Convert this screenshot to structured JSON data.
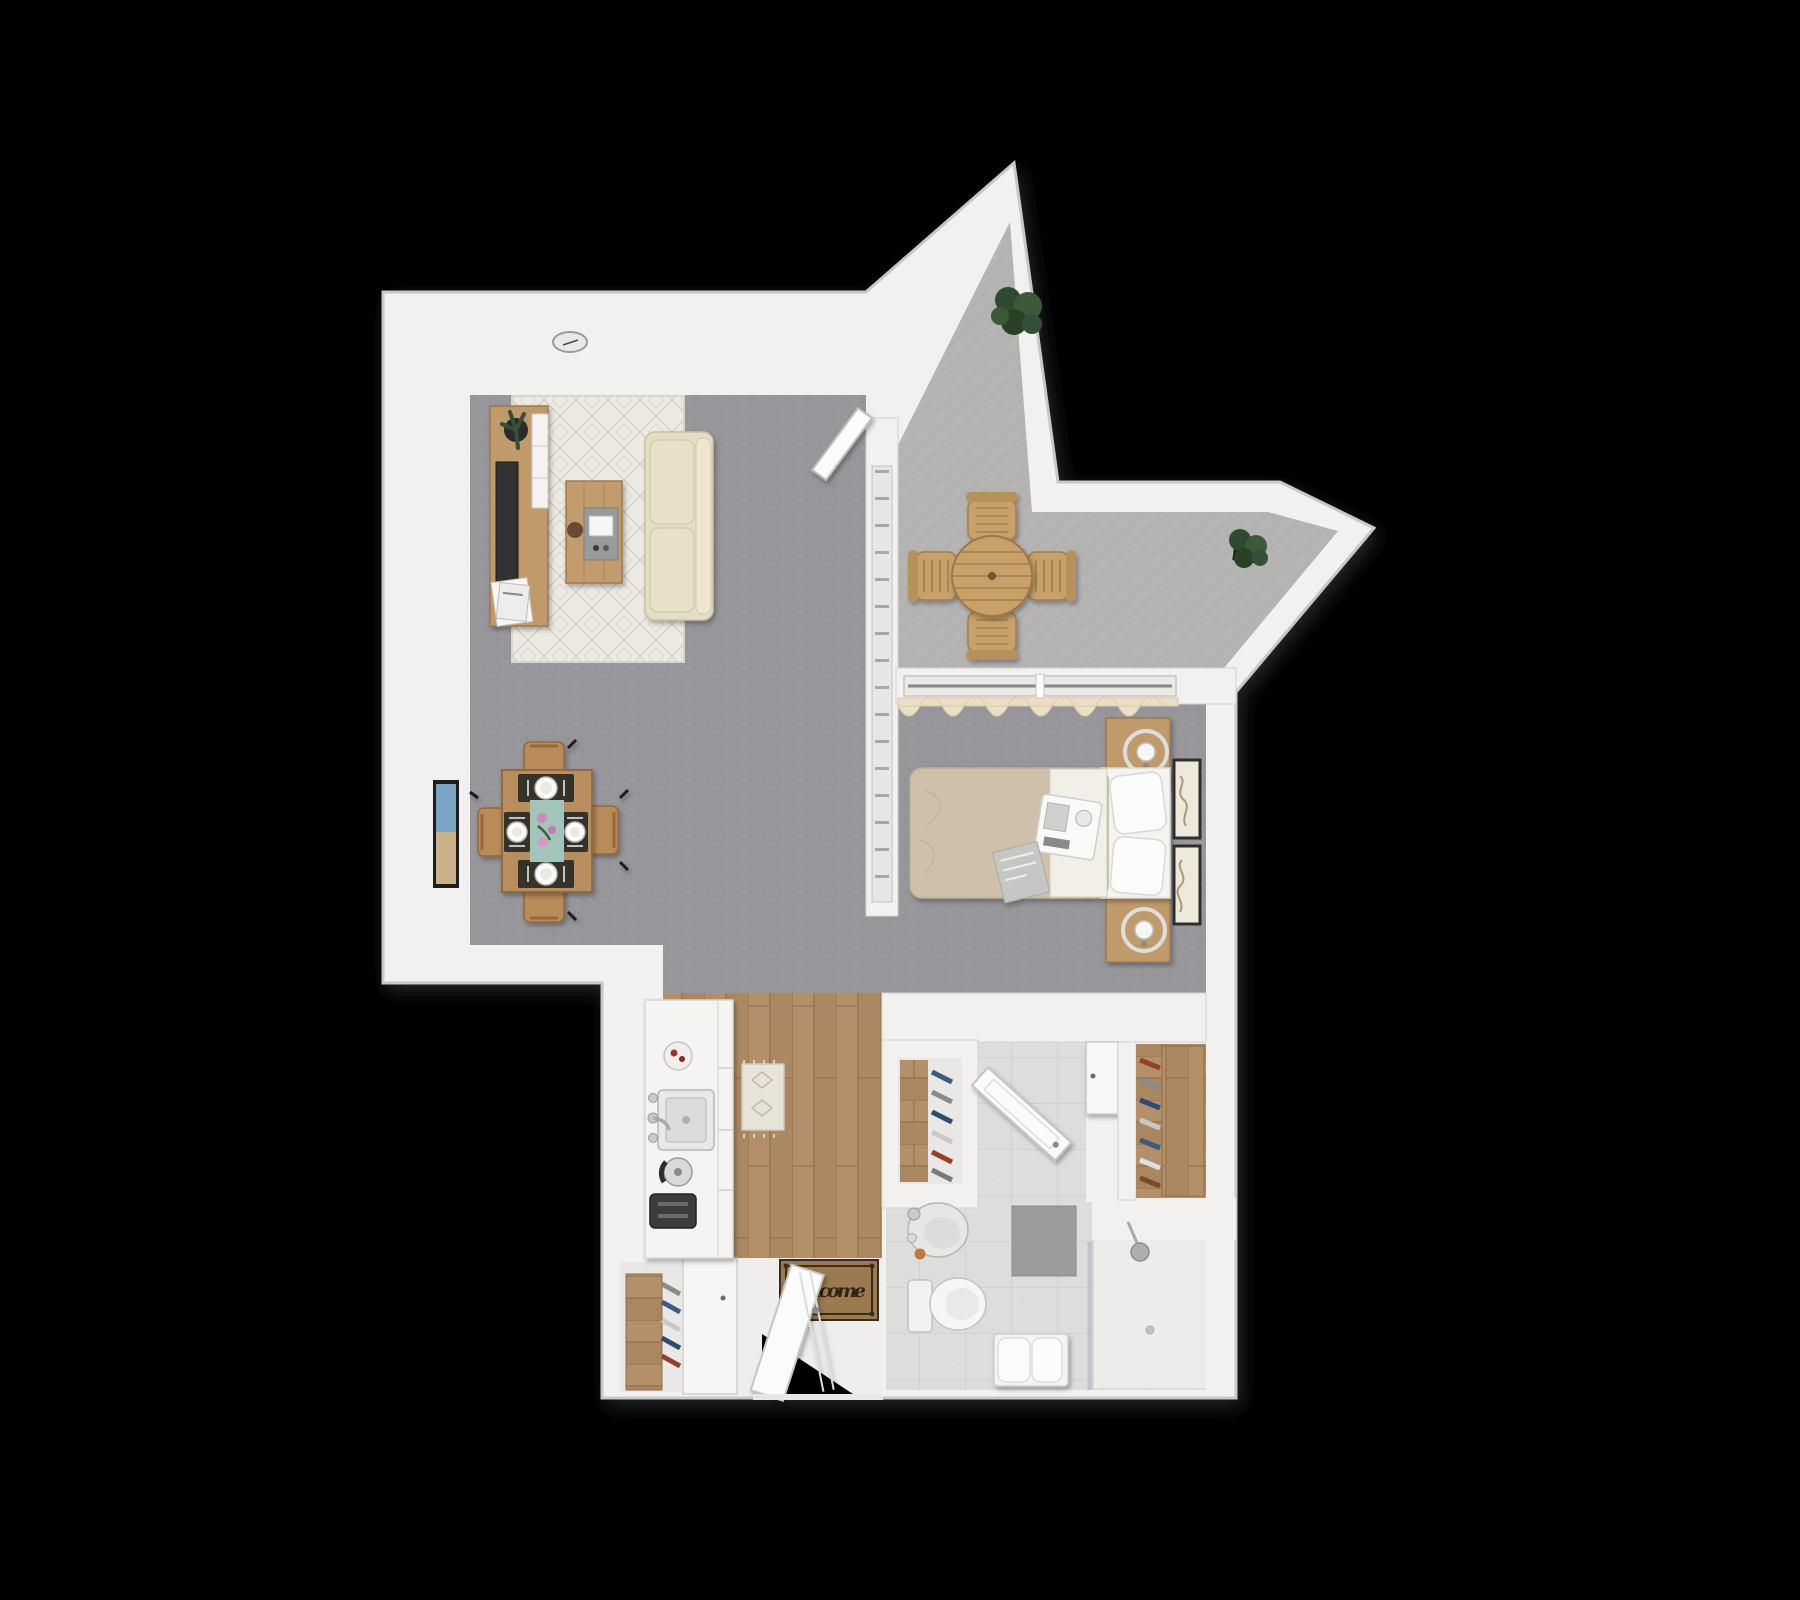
{
  "scene": {
    "description": "3D rendered top-down floor plan of a studio apartment on a black background",
    "background": "#000000"
  },
  "entry_mat": {
    "text": "welcome"
  },
  "colors": {
    "wall": "#f2f1ef",
    "wall_edge": "#c9c8c6",
    "carpet": "#97979b",
    "balcony_floor": "#b5b4b2",
    "wood_floor": "#b3906a",
    "tile_floor": "#dddddb",
    "shower_floor": "#ececea",
    "rug": "#edeae4",
    "runner_rug": "#e8e4da",
    "sofa": "#e6ddc5",
    "cushion": "#e9e0c9",
    "wood_furniture": "#c09a6a",
    "dining_table": "#b98e5f",
    "table_runner": "#a3c4bb",
    "flowers": "#d089c0",
    "duvet": "#cfc0ab",
    "linen": "#f4f3ef",
    "plant": "#35503a",
    "mat": "#9b7a50",
    "door": "#fbfbf9",
    "glass": "#b9c2c6",
    "tv": "#333336",
    "toaster": "#3c3c3a",
    "tray": "#9a9a98"
  },
  "rooms": {
    "living_room": {
      "name": "Living room",
      "furniture": [
        "media console",
        "tv",
        "console plant",
        "magazines",
        "area rug",
        "sofa",
        "coffee table",
        "ceiling light"
      ]
    },
    "dining_area": {
      "name": "Dining area",
      "furniture": [
        "dining table",
        "4 chairs",
        "4 place settings",
        "table runner with flowers",
        "wall window art"
      ]
    },
    "balcony": {
      "name": "Balcony",
      "furniture": [
        "round patio table",
        "4 patio chairs",
        "2 potted plants"
      ]
    },
    "sleeping_area": {
      "name": "Sleeping area",
      "furniture": [
        "double bed",
        "2 pillows",
        "breakfast tray",
        "magazine",
        "2 nightstands",
        "2 ring lamps",
        "2 wall pictures",
        "curtains",
        "sliding glass door"
      ]
    },
    "kitchen": {
      "name": "Kitchen",
      "furniture": [
        "counter",
        "plate with food",
        "sink",
        "kettle",
        "toaster",
        "end cabinet"
      ]
    },
    "hallway": {
      "name": "Entry hall",
      "furniture": [
        "runner rug",
        "welcome mat",
        "front door"
      ]
    },
    "entry_closet": {
      "name": "Entry closet",
      "furniture": [
        "shelf board",
        "hanging clothes"
      ]
    },
    "shoe_closet": {
      "name": "Shoe closet",
      "furniture": [
        "shelf board",
        "shoes"
      ]
    },
    "walk_in_closet": {
      "name": "Walk-in closet",
      "furniture": [
        "shelf board",
        "hanging clothes"
      ]
    },
    "bathroom": {
      "name": "Bathroom",
      "furniture": [
        "sink basin",
        "toilet",
        "bath mat",
        "bench with towels",
        "shower",
        "glass panel",
        "bathroom door",
        "wall cabinet"
      ]
    }
  }
}
